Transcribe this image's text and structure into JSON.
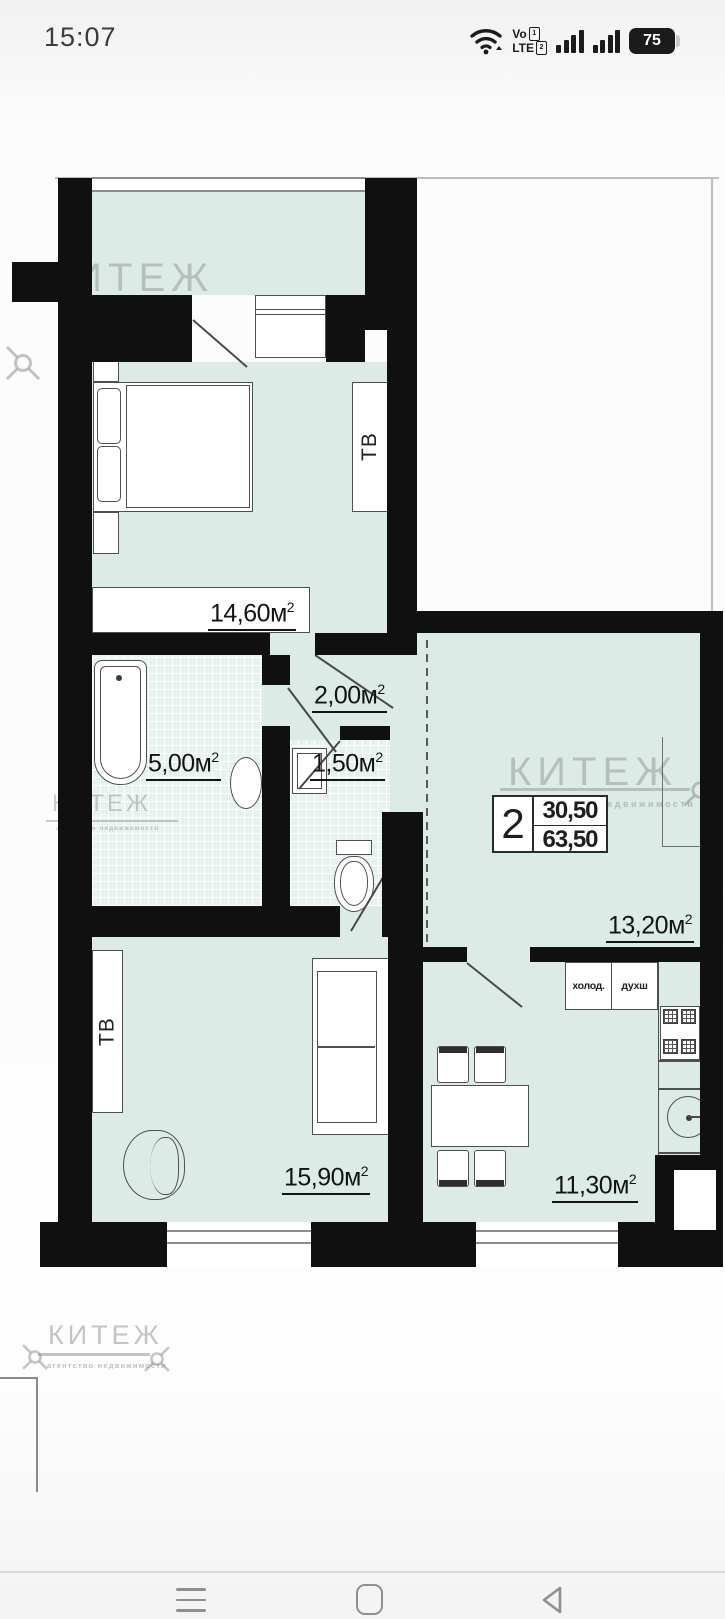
{
  "status_bar": {
    "time": "15:07",
    "net_label_top": "Vo",
    "net_label_bottom": "LTE",
    "sim_badge_1": "1",
    "sim_badge_2": "2",
    "battery_percent": "75"
  },
  "plan": {
    "unit": "м",
    "sup": "2",
    "rooms": {
      "bedroom": {
        "area": "14,60"
      },
      "hallway": {
        "area": "2,00"
      },
      "bathroom": {
        "area": "5,00"
      },
      "wc": {
        "area": "1,50"
      },
      "kitchen_living": {
        "area": "13,20"
      },
      "living": {
        "area": "15,90"
      },
      "dining": {
        "area": "11,30"
      }
    },
    "tv_label": "ТВ",
    "info_box": {
      "room_count": "2",
      "area_top": "30,50",
      "area_bottom": "63,50"
    },
    "appliances": {
      "fridge": "холод.",
      "oven": "духш"
    },
    "arrow_glyph": "←"
  },
  "watermark": {
    "brand": "КИТЕЖ",
    "tagline": "агентство недвижимости"
  },
  "colors": {
    "wall": "#101010",
    "room_fill": "#dcebe6",
    "drawing_line": "#4f4f4f"
  }
}
